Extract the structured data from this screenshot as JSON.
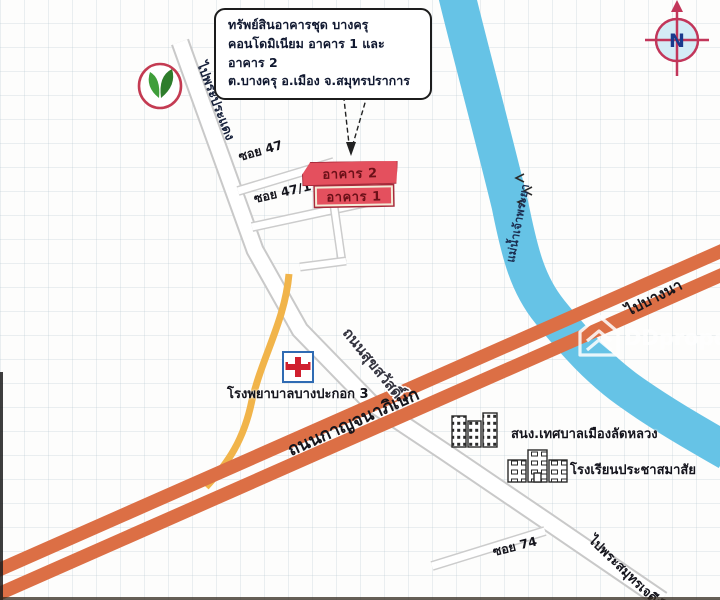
{
  "callout": {
    "line1": "ทรัพย์สินอาคารชุด บางครุ",
    "line2": "คอนโดมิเนียม อาคาร 1 และ อาคาร 2",
    "line3": "ต.บางครุ อ.เมือง จ.สมุทรปราการ"
  },
  "compass": {
    "label": "N"
  },
  "buildings": {
    "building2": "อาคาร 2",
    "building1": "อาคาร 1"
  },
  "roads": {
    "soi47": "ซอย 47",
    "soi47_1": "ซอย 47/1",
    "soi74": "ซอย 74",
    "to_phra_pradaeng": "ไปพระประแดง",
    "suksawat": "ถนนสุขสวัสดิ์",
    "kanchanaphisek": "ถนนกาญจนาภิเษก",
    "to_bang_na": "ไปบางนา",
    "to_phra_samut_chedi": "ไปพระสมุทรเจดีย์"
  },
  "river": {
    "name": "แม่น้ำเจ้าพระยา"
  },
  "places": {
    "hospital": "โรงพยาบาลบางปะกอก 3",
    "municipality": "สนง.เทศบาลเมืองลัดหลวง",
    "school": "โรงเรียนประชาสมาสัย"
  },
  "watermark": {
    "brand": "DDproperty"
  },
  "colors": {
    "river_blue": "#66c3e6",
    "highway_orange": "#dc6f45",
    "building_red": "#e4505e",
    "minor_road_yellow": "#f1b44a",
    "compass_crimson": "#c2365a",
    "logo_green": "#3f9e3a",
    "hospital_blue": "#2f6bb3",
    "cross_red": "#d0202e"
  }
}
